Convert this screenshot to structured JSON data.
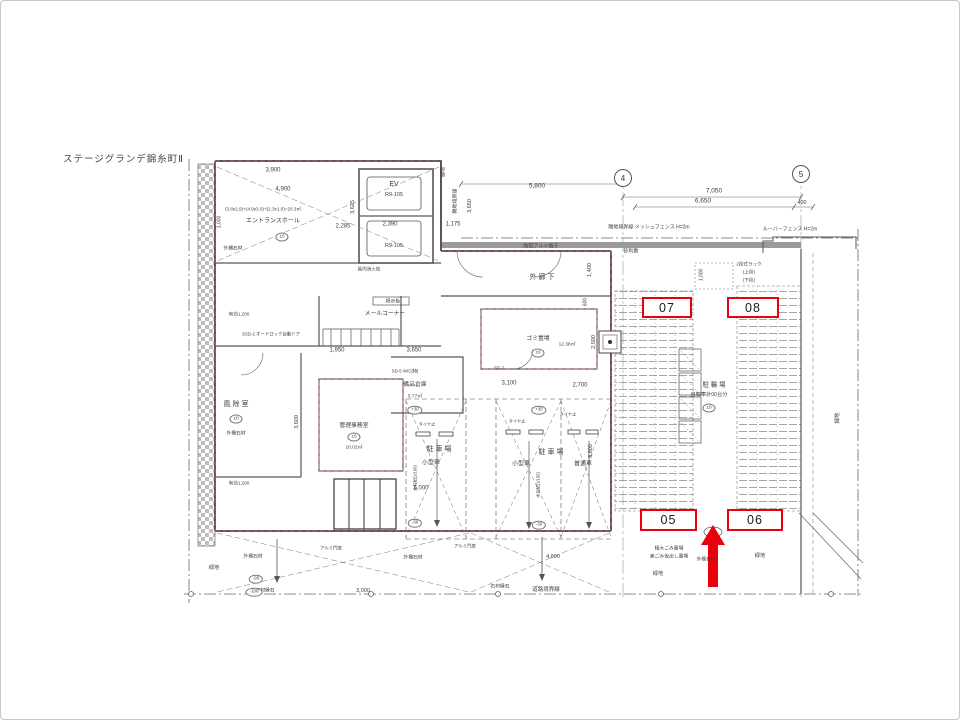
{
  "meta": {
    "title": "ステージグランデ錦糸町Ⅱ"
  },
  "annotations": {
    "color": "#e8000d",
    "boxes": [
      {
        "label": "07",
        "x": 641,
        "y": 296,
        "w": 50,
        "h": 21
      },
      {
        "label": "08",
        "x": 726,
        "y": 296,
        "w": 52,
        "h": 21
      },
      {
        "label": "05",
        "x": 639,
        "y": 508,
        "w": 57,
        "h": 22
      },
      {
        "label": "06",
        "x": 726,
        "y": 508,
        "w": 56,
        "h": 22
      }
    ],
    "arrow": {
      "x": 712,
      "tip_y": 524,
      "base_y": 586
    }
  },
  "grid_bubbles": [
    {
      "label": "4",
      "x": 622,
      "y": 177
    },
    {
      "label": "5",
      "x": 800,
      "y": 173
    }
  ],
  "plan": {
    "labels": [
      {
        "t": "3,900",
        "x": 272,
        "y": 170,
        "s": 6
      },
      {
        "t": "4,900",
        "x": 282,
        "y": 189,
        "s": 6
      },
      {
        "t": "(3.8x2.9)+(4.9x3.0)+(2.3x1.0)=20.3㎡",
        "x": 262,
        "y": 208,
        "s": 4.6
      },
      {
        "t": "エントランスホール",
        "x": 272,
        "y": 221,
        "s": 6
      },
      {
        "t": "±0",
        "x": 281,
        "y": 236,
        "s": 4.6,
        "ell": 1
      },
      {
        "t": "外構石材",
        "x": 232,
        "y": 248,
        "s": 4.8
      },
      {
        "t": "1,000",
        "x": 219,
        "y": 221,
        "s": 5,
        "r": -90
      },
      {
        "t": "2,285",
        "x": 342,
        "y": 226,
        "s": 6
      },
      {
        "t": "3,625",
        "x": 352,
        "y": 206,
        "s": 5.5,
        "r": -90
      },
      {
        "t": "EV",
        "x": 393,
        "y": 184,
        "s": 7
      },
      {
        "t": "R9-105",
        "x": 393,
        "y": 194,
        "s": 5.5
      },
      {
        "t": "2,390",
        "x": 389,
        "y": 224,
        "s": 6
      },
      {
        "t": "R9-105",
        "x": 393,
        "y": 245,
        "s": 5.5
      },
      {
        "t": "1,175",
        "x": 452,
        "y": 224,
        "s": 6
      },
      {
        "t": "緑地",
        "x": 443,
        "y": 171,
        "s": 5,
        "r": -90
      },
      {
        "t": "隣地境界線",
        "x": 455,
        "y": 200,
        "s": 5,
        "r": -90
      },
      {
        "t": "3,650",
        "x": 469,
        "y": 205,
        "s": 5.5,
        "r": -90
      },
      {
        "t": "5,800",
        "x": 536,
        "y": 185,
        "s": 6.5
      },
      {
        "t": "7,050",
        "x": 713,
        "y": 190,
        "s": 6.5
      },
      {
        "t": "6,650",
        "x": 702,
        "y": 200,
        "s": 6.5
      },
      {
        "t": "400",
        "x": 801,
        "y": 202,
        "s": 5.5
      },
      {
        "t": "隣地境界線  メッシュフェンス H=2m",
        "x": 648,
        "y": 227,
        "s": 5
      },
      {
        "t": "ルーバーフェンス H=2m",
        "x": 789,
        "y": 229,
        "s": 5
      },
      {
        "t": "砂利敷",
        "x": 630,
        "y": 251,
        "s": 5
      },
      {
        "t": "防犯アルミ格子",
        "x": 540,
        "y": 246,
        "s": 5
      },
      {
        "t": "外 廊 下",
        "x": 541,
        "y": 277,
        "s": 7
      },
      {
        "t": "1,400",
        "x": 589,
        "y": 269,
        "s": 5.5,
        "r": -90
      },
      {
        "t": "600",
        "x": 585,
        "y": 301,
        "s": 5,
        "r": -90
      },
      {
        "t": "2段式ラック",
        "x": 748,
        "y": 263,
        "s": 4.6
      },
      {
        "t": "(上段)",
        "x": 748,
        "y": 271,
        "s": 4.6
      },
      {
        "t": "(下段)",
        "x": 748,
        "y": 279,
        "s": 4.6
      },
      {
        "t": "1,000",
        "x": 701,
        "y": 274,
        "s": 5,
        "r": -90
      },
      {
        "t": "掲示板",
        "x": 392,
        "y": 301,
        "s": 4.8
      },
      {
        "t": "メールコーナー",
        "x": 384,
        "y": 313,
        "s": 5.8
      },
      {
        "t": "屋内消火栓",
        "x": 368,
        "y": 268,
        "s": 4.6
      },
      {
        "t": "風 除 室",
        "x": 235,
        "y": 404,
        "s": 7
      },
      {
        "t": "±0",
        "x": 235,
        "y": 418,
        "s": 4.6,
        "ell": 1
      },
      {
        "t": "外構石材",
        "x": 235,
        "y": 433,
        "s": 4.8
      },
      {
        "t": "有効1,200",
        "x": 238,
        "y": 313,
        "s": 4.6
      },
      {
        "t": "SSD-2 オートロック自動ドア",
        "x": 270,
        "y": 334,
        "s": 4.4
      },
      {
        "t": "1,950",
        "x": 336,
        "y": 350,
        "s": 6
      },
      {
        "t": "3,650",
        "x": 413,
        "y": 350,
        "s": 6
      },
      {
        "t": "SD-5 WIC[特]",
        "x": 404,
        "y": 371,
        "s": 4.4
      },
      {
        "t": "備品倉庫",
        "x": 414,
        "y": 384,
        "s": 5.8
      },
      {
        "t": "5.77㎡",
        "x": 414,
        "y": 396,
        "s": 4.8
      },
      {
        "t": "管理事務室",
        "x": 353,
        "y": 425,
        "s": 5.8
      },
      {
        "t": "±0",
        "x": 353,
        "y": 436,
        "s": 4.6,
        "ell": 1
      },
      {
        "t": "10.02㎡",
        "x": 353,
        "y": 447,
        "s": 4.8
      },
      {
        "t": "3,600",
        "x": 296,
        "y": 421,
        "s": 5.5,
        "r": -90
      },
      {
        "t": "有効1,200",
        "x": 238,
        "y": 482,
        "s": 4.6
      },
      {
        "t": "ゴミ置場",
        "x": 537,
        "y": 338,
        "s": 5.8
      },
      {
        "t": "12.38㎡",
        "x": 566,
        "y": 344,
        "s": 4.8
      },
      {
        "t": "±0",
        "x": 537,
        "y": 352,
        "s": 4.6,
        "ell": 1
      },
      {
        "t": "2,500",
        "x": 593,
        "y": 341,
        "s": 5.5,
        "r": -90
      },
      {
        "t": "3,100",
        "x": 508,
        "y": 383,
        "s": 6
      },
      {
        "t": "2,700",
        "x": 579,
        "y": 385,
        "s": 6
      },
      {
        "t": "SD-7",
        "x": 498,
        "y": 368,
        "s": 4.4
      },
      {
        "t": "駐 車 場",
        "x": 438,
        "y": 449,
        "s": 7
      },
      {
        "t": "小型車",
        "x": 430,
        "y": 463,
        "s": 6
      },
      {
        "t": "駐 車 場",
        "x": 550,
        "y": 452,
        "s": 7
      },
      {
        "t": "小型車",
        "x": 520,
        "y": 464,
        "s": 6
      },
      {
        "t": "普通車",
        "x": 582,
        "y": 464,
        "s": 6
      },
      {
        "t": "5,000",
        "x": 420,
        "y": 488,
        "s": 6
      },
      {
        "t": "5,800",
        "x": 590,
        "y": 450,
        "s": 5.5,
        "r": -90
      },
      {
        "t": "水勾配(1/100)",
        "x": 415,
        "y": 477,
        "s": 4.2,
        "r": -90
      },
      {
        "t": "水勾配(1/100)",
        "x": 538,
        "y": 484,
        "s": 4.2,
        "r": -90
      },
      {
        "t": "タイヤ止",
        "x": 426,
        "y": 424,
        "s": 4.2
      },
      {
        "t": "タイヤ止",
        "x": 516,
        "y": 421,
        "s": 4.2
      },
      {
        "t": "タイヤ止",
        "x": 567,
        "y": 414,
        "s": 4.2
      },
      {
        "t": "駐 輪 場",
        "x": 713,
        "y": 384,
        "s": 6.5
      },
      {
        "t": "自転車計00台分",
        "x": 708,
        "y": 395,
        "s": 5.2
      },
      {
        "t": "±0",
        "x": 708,
        "y": 407,
        "s": 4.6,
        "ell": 1
      },
      {
        "t": "+30",
        "x": 414,
        "y": 409,
        "s": 4.4,
        "ell": 1
      },
      {
        "t": "+30",
        "x": 538,
        "y": 409,
        "s": 4.4,
        "ell": 1
      },
      {
        "t": "-30",
        "x": 414,
        "y": 522,
        "s": 4.4,
        "ell": 1
      },
      {
        "t": "-30",
        "x": 538,
        "y": 524,
        "s": 4.4,
        "ell": 1
      },
      {
        "t": "緑地",
        "x": 837,
        "y": 417,
        "s": 5.5,
        "r": -90
      },
      {
        "t": "粗大ごみ置場",
        "x": 668,
        "y": 548,
        "s": 4.8
      },
      {
        "t": "兼ごみ仮出し置場",
        "x": 668,
        "y": 556,
        "s": 4.8
      },
      {
        "t": "外構石材",
        "x": 705,
        "y": 558,
        "s": 4.6
      },
      {
        "t": "緑地",
        "x": 759,
        "y": 556,
        "s": 5.2
      },
      {
        "t": "緑地",
        "x": 657,
        "y": 574,
        "s": 5.2
      },
      {
        "t": "アルミ門扉",
        "x": 330,
        "y": 548,
        "s": 4.4
      },
      {
        "t": "アルミ門扉",
        "x": 464,
        "y": 546,
        "s": 4.4
      },
      {
        "t": "外構石材",
        "x": 252,
        "y": 556,
        "s": 4.8
      },
      {
        "t": "緑地",
        "x": 213,
        "y": 568,
        "s": 5.2
      },
      {
        "t": "外構石材",
        "x": 412,
        "y": 557,
        "s": 4.8
      },
      {
        "t": "石材縁石",
        "x": 264,
        "y": 590,
        "s": 4.8
      },
      {
        "t": "-90",
        "x": 255,
        "y": 578,
        "s": 4.4,
        "ell": 1
      },
      {
        "t": "-100",
        "x": 253,
        "y": 591,
        "s": 4.4,
        "ell": 1
      },
      {
        "t": "3,000",
        "x": 362,
        "y": 590,
        "s": 5.5
      },
      {
        "t": "4,800",
        "x": 552,
        "y": 556,
        "s": 5.5
      },
      {
        "t": "道路境界線",
        "x": 545,
        "y": 589,
        "s": 5.5
      },
      {
        "t": "石材縁石",
        "x": 499,
        "y": 586,
        "s": 4.8
      }
    ]
  }
}
